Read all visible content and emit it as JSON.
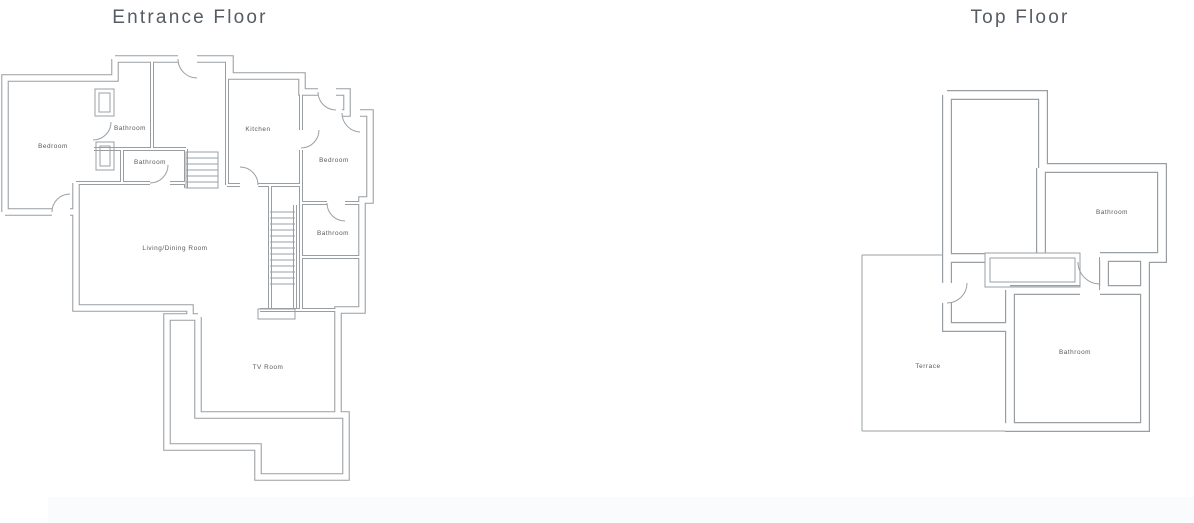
{
  "colors": {
    "wall": "#989ea2",
    "room_label": "#55595c",
    "title": "#565c63",
    "footer_bar": "#fafbfc",
    "background": "#ffffff"
  },
  "plans": [
    {
      "name": "Entrance Floor",
      "rooms": [
        {
          "label": "Bedroom"
        },
        {
          "label": "Bathroom"
        },
        {
          "label": "Bathroom"
        },
        {
          "label": "Kitchen"
        },
        {
          "label": "Bedroom"
        },
        {
          "label": "Bathroom"
        },
        {
          "label": "Living/Dining Room"
        },
        {
          "label": "TV Room"
        }
      ]
    },
    {
      "name": "Top Floor",
      "rooms": [
        {
          "label": "Bathroom"
        },
        {
          "label": "Bathroom"
        },
        {
          "label": "Terrace"
        }
      ]
    }
  ]
}
